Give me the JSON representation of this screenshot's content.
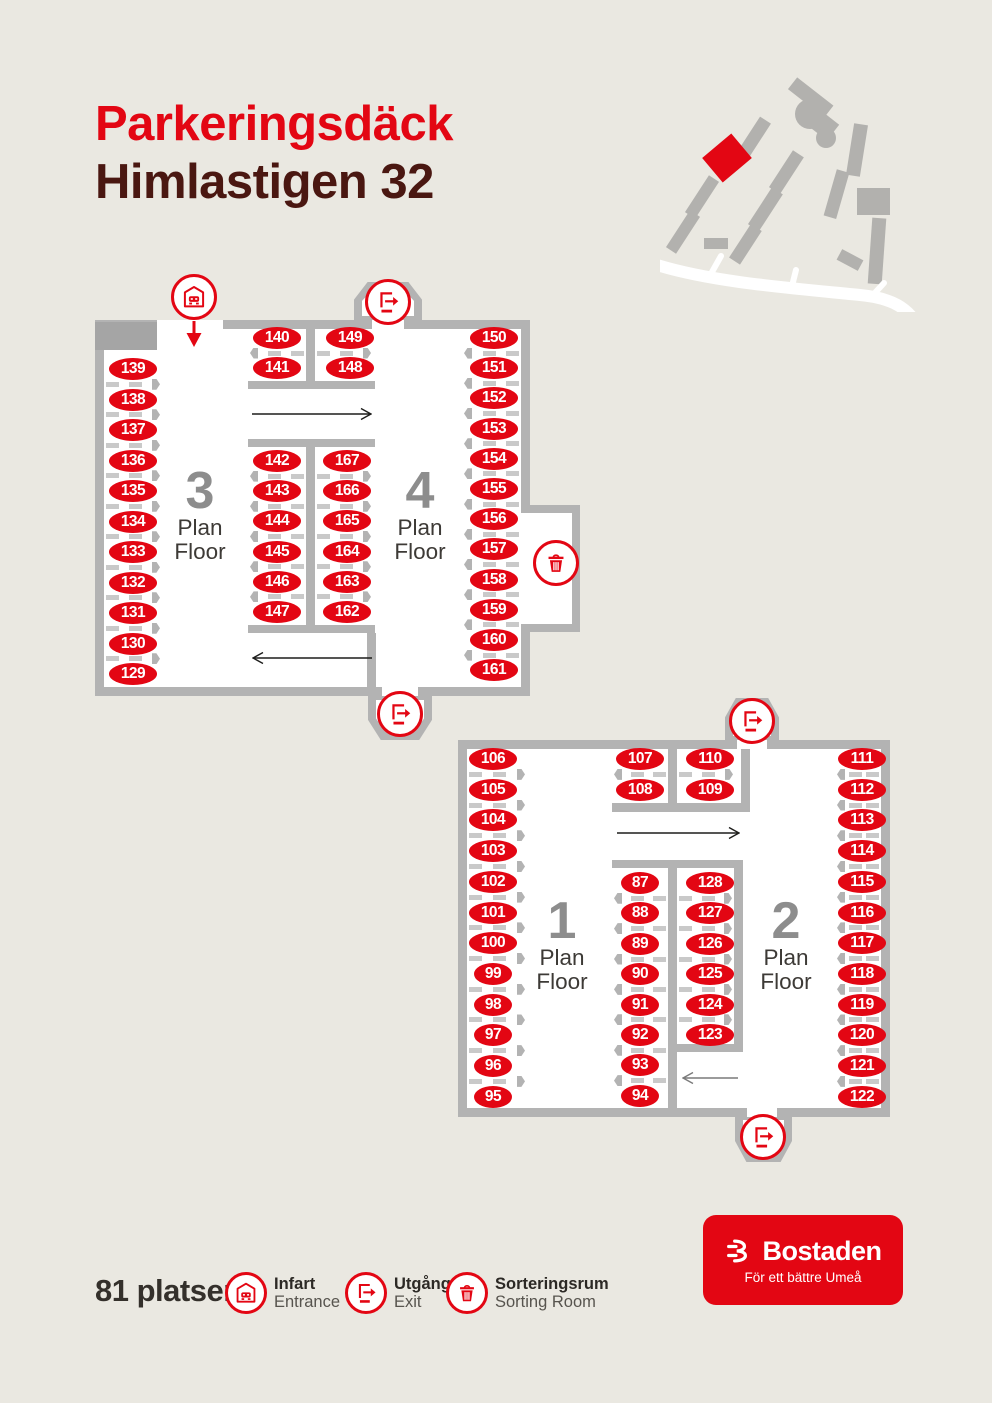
{
  "title": {
    "line1": "Parkeringsdäck",
    "line2": "Himlastigen 32"
  },
  "colors": {
    "red": "#E30613",
    "dark_red_title": "#4A1711",
    "wall_gray": "#B3B3B3",
    "block_gray": "#A5A5A5",
    "dash_gray": "#C9C9C9",
    "floor_number_gray": "#8D8D8D",
    "background": "#EAE8E1"
  },
  "legend": {
    "total_label": "81 platser",
    "items": [
      {
        "icon": "entrance",
        "sv": "Infart",
        "en": "Entrance"
      },
      {
        "icon": "exit",
        "sv": "Utgång",
        "en": "Exit"
      },
      {
        "icon": "sorting",
        "sv": "Sorteringsrum",
        "en": "Sorting Room"
      }
    ]
  },
  "logo": {
    "name": "Bostaden",
    "tagline": "För ett bättre Umeå"
  },
  "plans": [
    {
      "id": "floors-3-4",
      "floor_labels": [
        {
          "number": "3",
          "word1": "Plan",
          "word2": "Floor",
          "cx": 200,
          "top": 466
        },
        {
          "number": "4",
          "word1": "Plan",
          "word2": "Floor",
          "cx": 420,
          "top": 466
        }
      ],
      "spot_groups": [
        {
          "name": "floor3-left-row",
          "x": 133,
          "y0": 369,
          "step": 30.5,
          "knob": "right",
          "div_x1": 106,
          "div_x2": 160,
          "numbers": [
            139,
            138,
            137,
            136,
            135,
            134,
            133,
            132,
            131,
            130,
            129
          ]
        },
        {
          "name": "floor3-top-cell",
          "x": 277,
          "y0": 338,
          "step": 30,
          "knob": "left",
          "div_x1": 250,
          "div_x2": 304,
          "numbers": [
            140,
            141
          ]
        },
        {
          "name": "floor4-top-cell",
          "x": 350,
          "y0": 338,
          "step": 30,
          "knob": "right",
          "div_x1": 317,
          "div_x2": 371,
          "numbers": [
            149,
            148
          ]
        },
        {
          "name": "floor3-mid-row",
          "x": 277,
          "y0": 461,
          "step": 30.2,
          "knob": "left",
          "div_x1": 250,
          "div_x2": 304,
          "numbers": [
            142,
            143,
            144,
            145,
            146,
            147
          ]
        },
        {
          "name": "floor4-mid-row",
          "x": 347,
          "y0": 461,
          "step": 30.2,
          "knob": "right",
          "div_x1": 317,
          "div_x2": 371,
          "numbers": [
            167,
            166,
            165,
            164,
            163,
            162
          ]
        },
        {
          "name": "floor4-right-row",
          "x": 494,
          "y0": 338,
          "step": 30.2,
          "knob": "left",
          "div_x1": 464,
          "div_x2": 519,
          "numbers": [
            150,
            151,
            152,
            153,
            154,
            155,
            156,
            157,
            158,
            159,
            160,
            161
          ]
        }
      ],
      "markers": [
        {
          "type": "entrance",
          "x": 194,
          "y": 297,
          "arrow_down": true
        },
        {
          "type": "exit",
          "x": 388,
          "y": 302
        },
        {
          "type": "exit",
          "x": 400,
          "y": 714
        },
        {
          "type": "sorting",
          "x": 556,
          "y": 563
        }
      ],
      "arrows": [
        {
          "x1": 252,
          "x2": 372,
          "y": 414,
          "dir": "right",
          "color": "#1D1D1B"
        },
        {
          "x1": 252,
          "x2": 372,
          "y": 658,
          "dir": "left",
          "color": "#1D1D1B"
        }
      ]
    },
    {
      "id": "floors-1-2",
      "floor_labels": [
        {
          "number": "1",
          "word1": "Plan",
          "word2": "Floor",
          "cx": 562,
          "top": 896
        },
        {
          "number": "2",
          "word1": "Plan",
          "word2": "Floor",
          "cx": 786,
          "top": 896
        }
      ],
      "spot_groups": [
        {
          "name": "floor1-left-row",
          "x": 493,
          "y0": 759,
          "step": 30.7,
          "knob": "right",
          "div_x1": 469,
          "div_x2": 525,
          "numbers": [
            106,
            105,
            104,
            103,
            102,
            101,
            100,
            99,
            98,
            97,
            96,
            95
          ]
        },
        {
          "name": "floor1-top-cell",
          "x": 640,
          "y0": 759,
          "step": 30.7,
          "knob": "left",
          "div_x1": 614,
          "div_x2": 666,
          "numbers": [
            107,
            108
          ]
        },
        {
          "name": "floor2-top-cell",
          "x": 710,
          "y0": 759,
          "step": 30.7,
          "knob": "right",
          "div_x1": 679,
          "div_x2": 733,
          "numbers": [
            110,
            109
          ]
        },
        {
          "name": "floor1-mid-row",
          "x": 640,
          "y0": 883,
          "step": 30.4,
          "knob": "left",
          "div_x1": 614,
          "div_x2": 666,
          "numbers": [
            87,
            88,
            89,
            90,
            91,
            92,
            93,
            94
          ]
        },
        {
          "name": "floor2-mid-row",
          "x": 710,
          "y0": 883,
          "step": 30.4,
          "knob": "right",
          "div_x1": 679,
          "div_x2": 732,
          "numbers": [
            128,
            127,
            126,
            125,
            124,
            123
          ]
        },
        {
          "name": "floor2-right-row",
          "x": 862,
          "y0": 759,
          "step": 30.7,
          "knob": "left",
          "div_x1": 837,
          "div_x2": 879,
          "numbers": [
            111,
            112,
            113,
            114,
            115,
            116,
            117,
            118,
            119,
            120,
            121,
            122
          ]
        }
      ],
      "markers": [
        {
          "type": "exit",
          "x": 752,
          "y": 721
        },
        {
          "type": "exit",
          "x": 763,
          "y": 1137
        }
      ],
      "arrows": [
        {
          "x1": 617,
          "x2": 740,
          "y": 833,
          "dir": "right",
          "color": "#1D1D1B"
        },
        {
          "x1": 682,
          "x2": 738,
          "y": 1078,
          "dir": "left",
          "color": "#7A7A7A"
        }
      ]
    }
  ]
}
